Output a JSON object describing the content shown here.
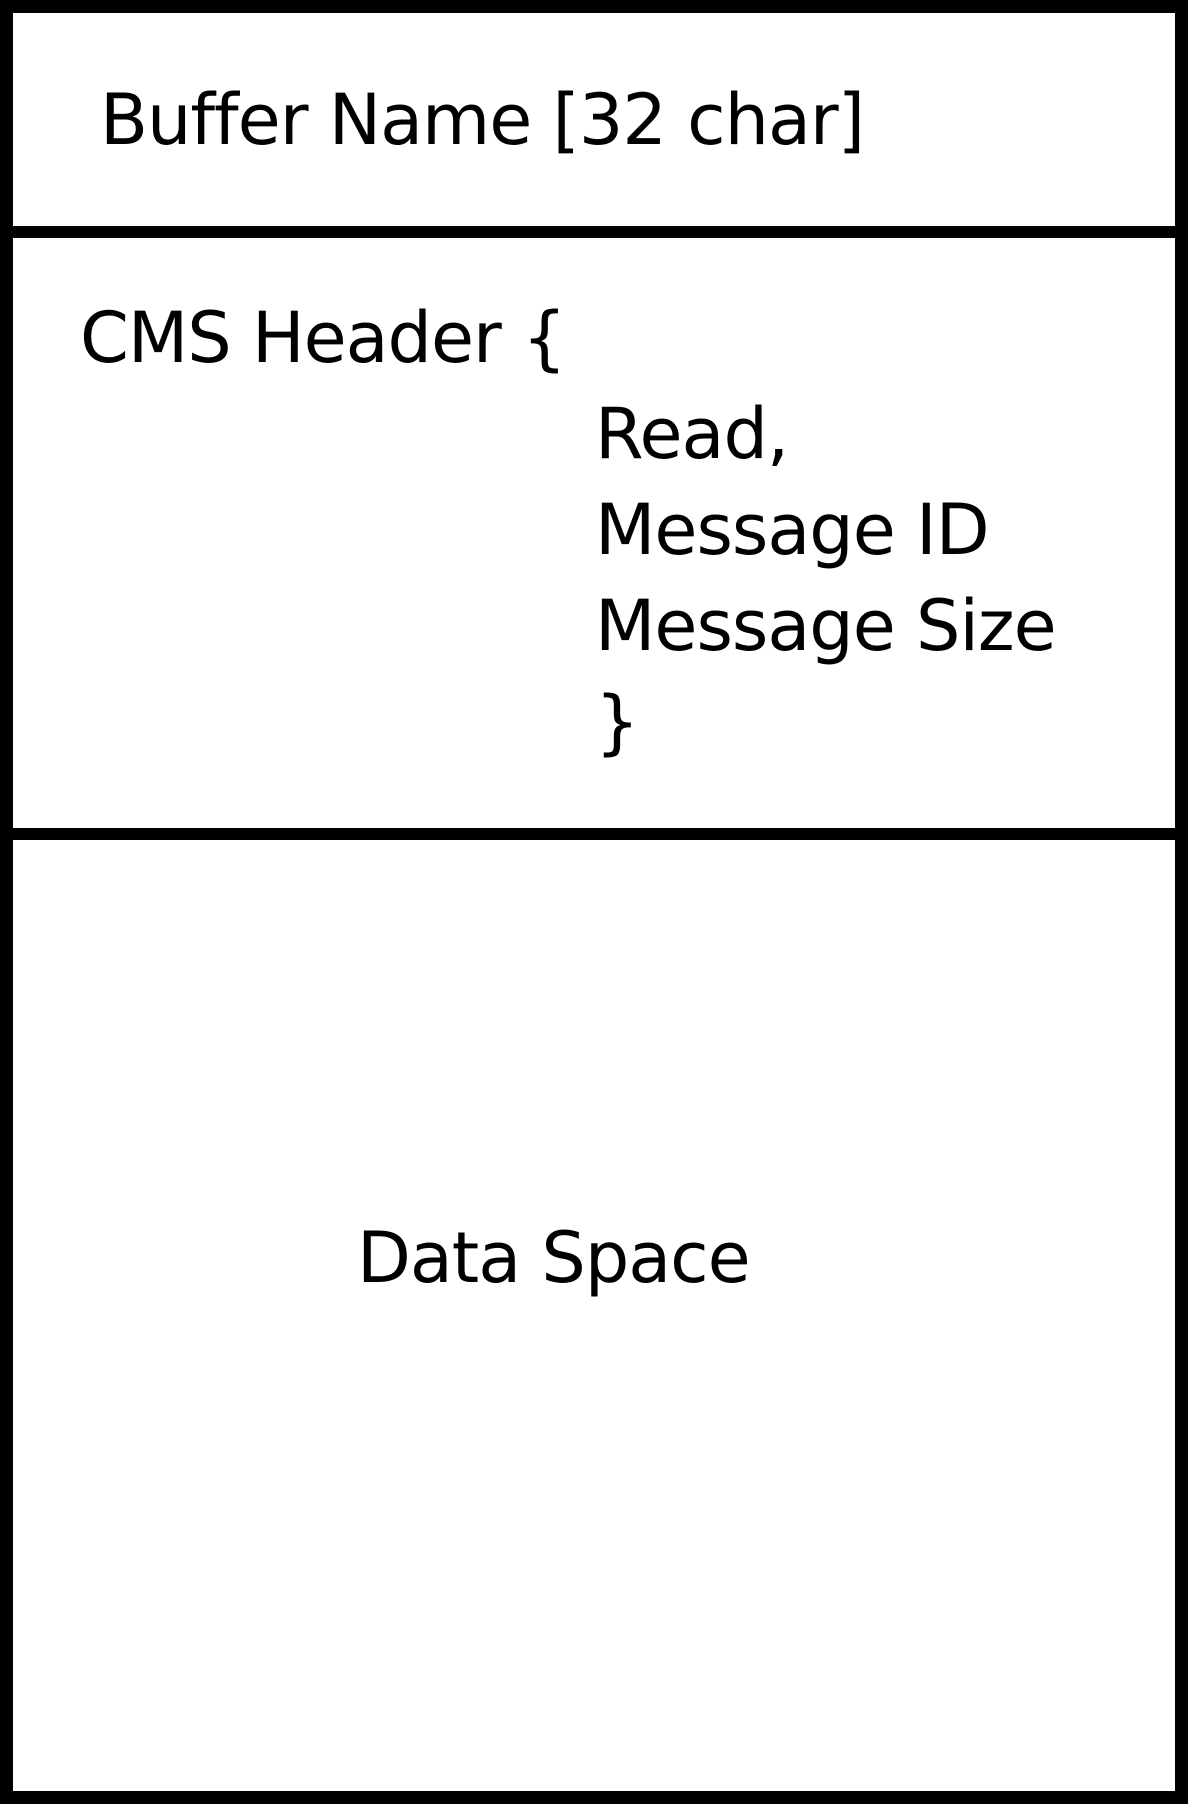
{
  "diagram": {
    "buffer_name": "Buffer Name [32 char]",
    "cms_header": {
      "open": "CMS Header {",
      "fields": [
        "Read,",
        "Message ID",
        "Message Size"
      ],
      "close": "}"
    },
    "data_space": "Data Space",
    "colors": {
      "ink": "#000000",
      "background": "#ffffff"
    }
  }
}
